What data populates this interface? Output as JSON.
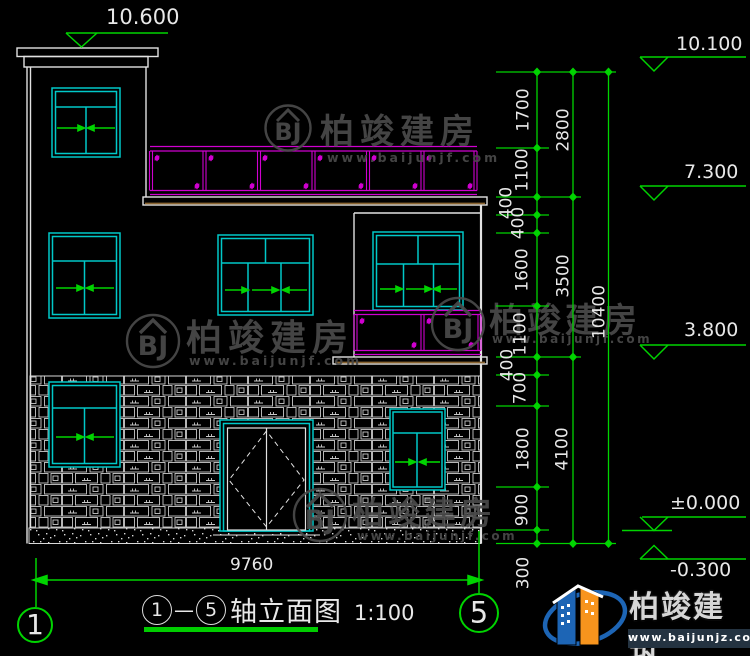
{
  "drawing": {
    "top_elevation": "10.600",
    "bottom_width": "9760",
    "overall_height": "10400",
    "elevations": [
      "10.100",
      "7.300",
      "3.800",
      "±0.000",
      "-0.300"
    ],
    "chain1": [
      "1700",
      "1100",
      "400",
      "400",
      "1600",
      "1100",
      "400",
      "700",
      "1800",
      "900",
      "300"
    ],
    "chain2": [
      "2800",
      "3500",
      "4100"
    ],
    "axis_bubbles": {
      "left": "1",
      "right": "5"
    },
    "title": {
      "axis_start": "1",
      "dash": "—",
      "axis_end": "5",
      "name": "轴立面图",
      "scale": "1:100"
    }
  },
  "watermark": {
    "monogram": "BJ",
    "name": "柏竣建房",
    "url": "www.baijunjf.com"
  },
  "brand": {
    "name": "柏竣建筑",
    "url": "www.baijunjz.com"
  },
  "colors": {
    "dim_green": "#00d400",
    "window_cyan": "#00c8c8",
    "railing_magenta": "#cf00cf",
    "line_white": "#e2e2e2",
    "watermark_gray": "#4a4a4a",
    "brand_blue": "#1d65b5",
    "brand_orange": "#f7941d"
  }
}
